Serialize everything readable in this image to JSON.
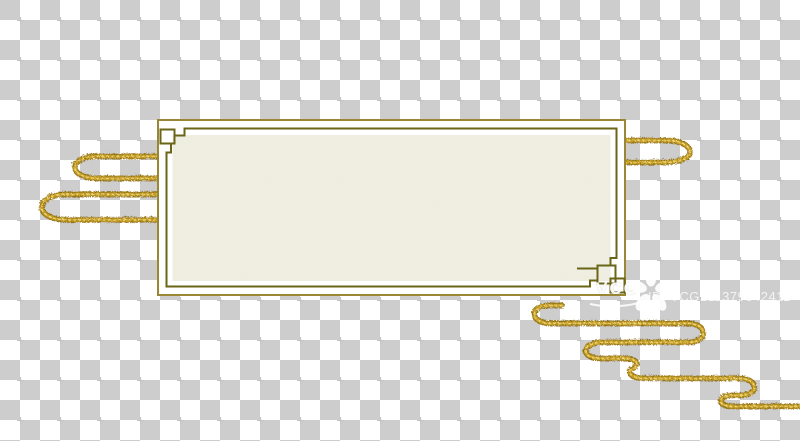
{
  "watermark": {
    "brand": "VCG",
    "id_text": "ID: VCG211379642411"
  },
  "colors": {
    "checker_light": "#ffffff",
    "checker_dark": "#cdcdcd",
    "frame_outer_gold": "#9a8733",
    "frame_inner_olive": "#6b6517",
    "panel_cream": "#f0efe2",
    "swirl_gold": "#c49b24",
    "swirl_gold_dark": "#8f6f14",
    "swirl_gold_light": "#ecd87c",
    "watermark_white": "#ffffff"
  }
}
